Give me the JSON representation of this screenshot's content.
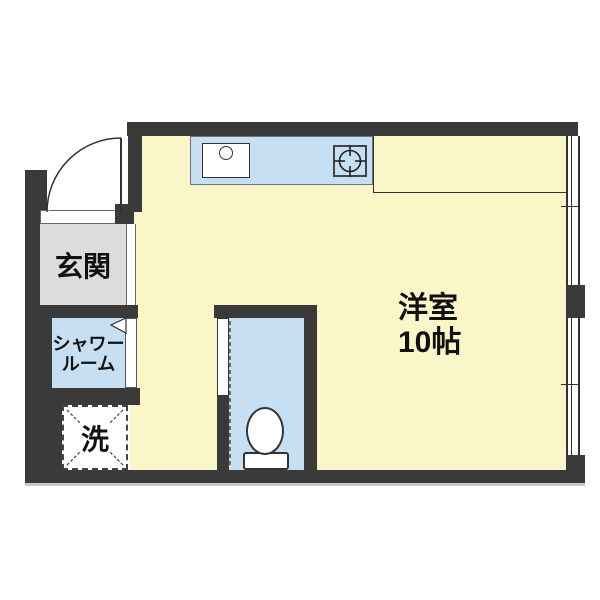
{
  "rooms": {
    "main": {
      "name": "洋室",
      "size": "10帖"
    },
    "entrance": {
      "name": "玄関"
    },
    "shower": {
      "line1": "シャワー",
      "line2": "ルーム"
    },
    "laundry": {
      "name": "洗"
    }
  },
  "colors": {
    "wall": "#3a3a3a",
    "floor": "#fbf6c8",
    "water": "#c6dff2",
    "entrance_floor": "#dcdcdc",
    "outline": "#333333",
    "shadow": "#c9c9c9",
    "background": "#ffffff",
    "ink": "#111111"
  }
}
